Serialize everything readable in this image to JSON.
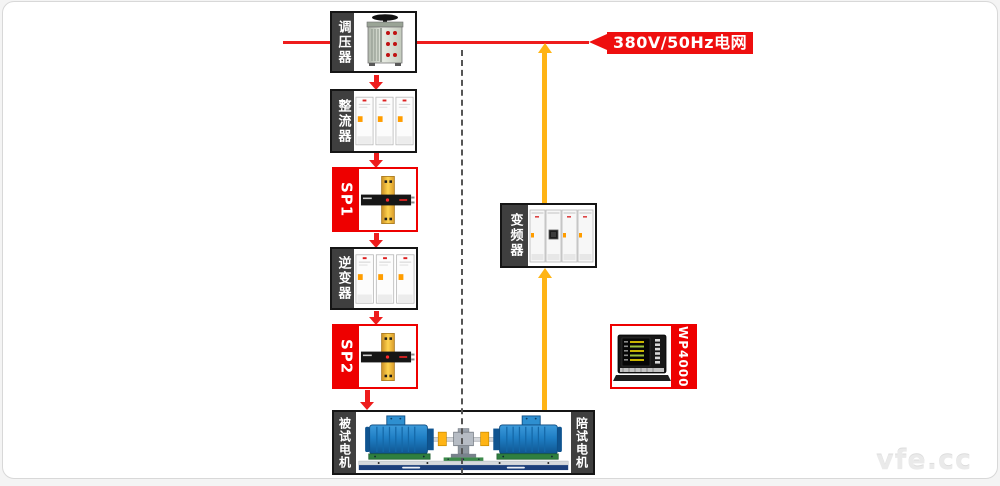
{
  "page": {
    "watermark": "vfe.cc"
  },
  "diagram": {
    "grid_label": "380V/50Hz电网",
    "nodes": {
      "regulator": {
        "label": "调压器"
      },
      "rectifier": {
        "label": "整流器"
      },
      "sp1": {
        "label": "SP1"
      },
      "inverter": {
        "label": "逆变器"
      },
      "sp2": {
        "label": "SP2"
      },
      "vfd": {
        "label": "变频器"
      },
      "wp4000": {
        "label": "WP4000"
      },
      "test_motor": {
        "label": "被试电机"
      },
      "accompany_motor": {
        "label": "陪试电机"
      }
    },
    "colors": {
      "flow_red": "#ee1c1c",
      "flow_yellow": "#ffb414",
      "label_dark_bg": "#3f3f3f",
      "sp_red": "#ee0000"
    }
  }
}
